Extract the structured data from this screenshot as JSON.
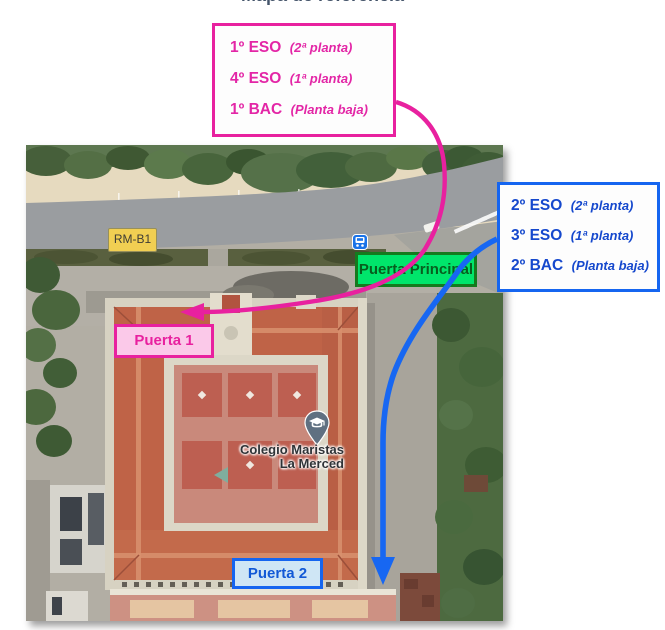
{
  "page": {
    "title": "Mapa de referencia"
  },
  "legend_pink": {
    "items": [
      {
        "group": "1º ESO",
        "floor": "(2ª planta)"
      },
      {
        "group": "4º ESO",
        "floor": "(1ª planta)"
      },
      {
        "group": "1º BAC",
        "floor": "(Planta baja)"
      }
    ]
  },
  "legend_blue": {
    "items": [
      {
        "group": "2º ESO",
        "floor": "(2ª planta)"
      },
      {
        "group": "3º ESO",
        "floor": "(1ª planta)"
      },
      {
        "group": "2º BAC",
        "floor": "(Planta baja)"
      }
    ]
  },
  "map": {
    "labels": {
      "bus_stop": "RM-B1",
      "main_entrance": "Puerta Principal",
      "door1": "Puerta 1",
      "door2": "Puerta 2",
      "place_line1": "Colegio Maristas",
      "place_line2": "La Merced"
    },
    "icons": {
      "bus": "bus-stop-icon",
      "pin": "school-place-pin",
      "pin_glyph": "graduation-cap-icon"
    }
  },
  "colors": {
    "pink_route": "#e8219f",
    "blue_route": "#1767f2",
    "green_entrance_fill": "#00e56b",
    "green_entrance_border": "#157a1e",
    "bus_badge_yellow": "#f1cf52",
    "title_gray": "#44546a"
  }
}
